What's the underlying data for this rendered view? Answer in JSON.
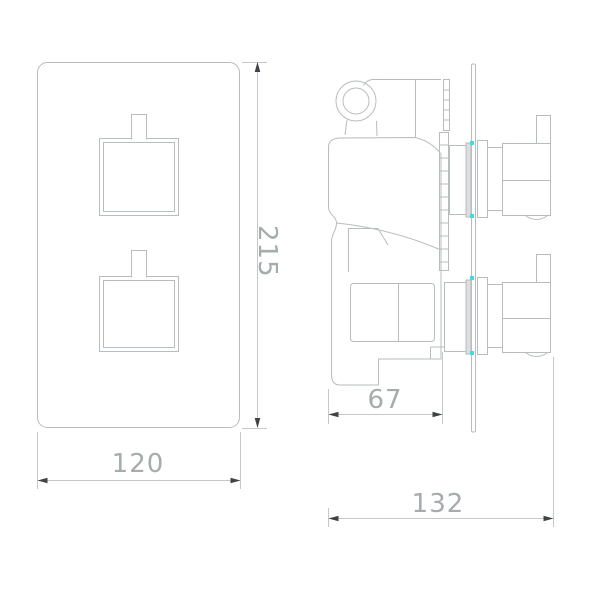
{
  "document": {
    "type": "technical-drawing",
    "subject": "concealed twin thermostatic shower valve - front and side elevations",
    "background": "#ffffff"
  },
  "views": {
    "front": {
      "label": "front-elevation",
      "dims": {
        "height": "215",
        "width": "120"
      }
    },
    "side": {
      "label": "side-elevation",
      "dims": {
        "body_depth": "67",
        "overall_depth": "132"
      }
    }
  },
  "colors": {
    "outline": "#b7bcbe",
    "dimension_line": "#c4c8c9",
    "arrow": "#3f4345",
    "dimension_text": "#a6abad",
    "marker": "#3fdbe0",
    "flange_fill": "#dcdedf"
  }
}
